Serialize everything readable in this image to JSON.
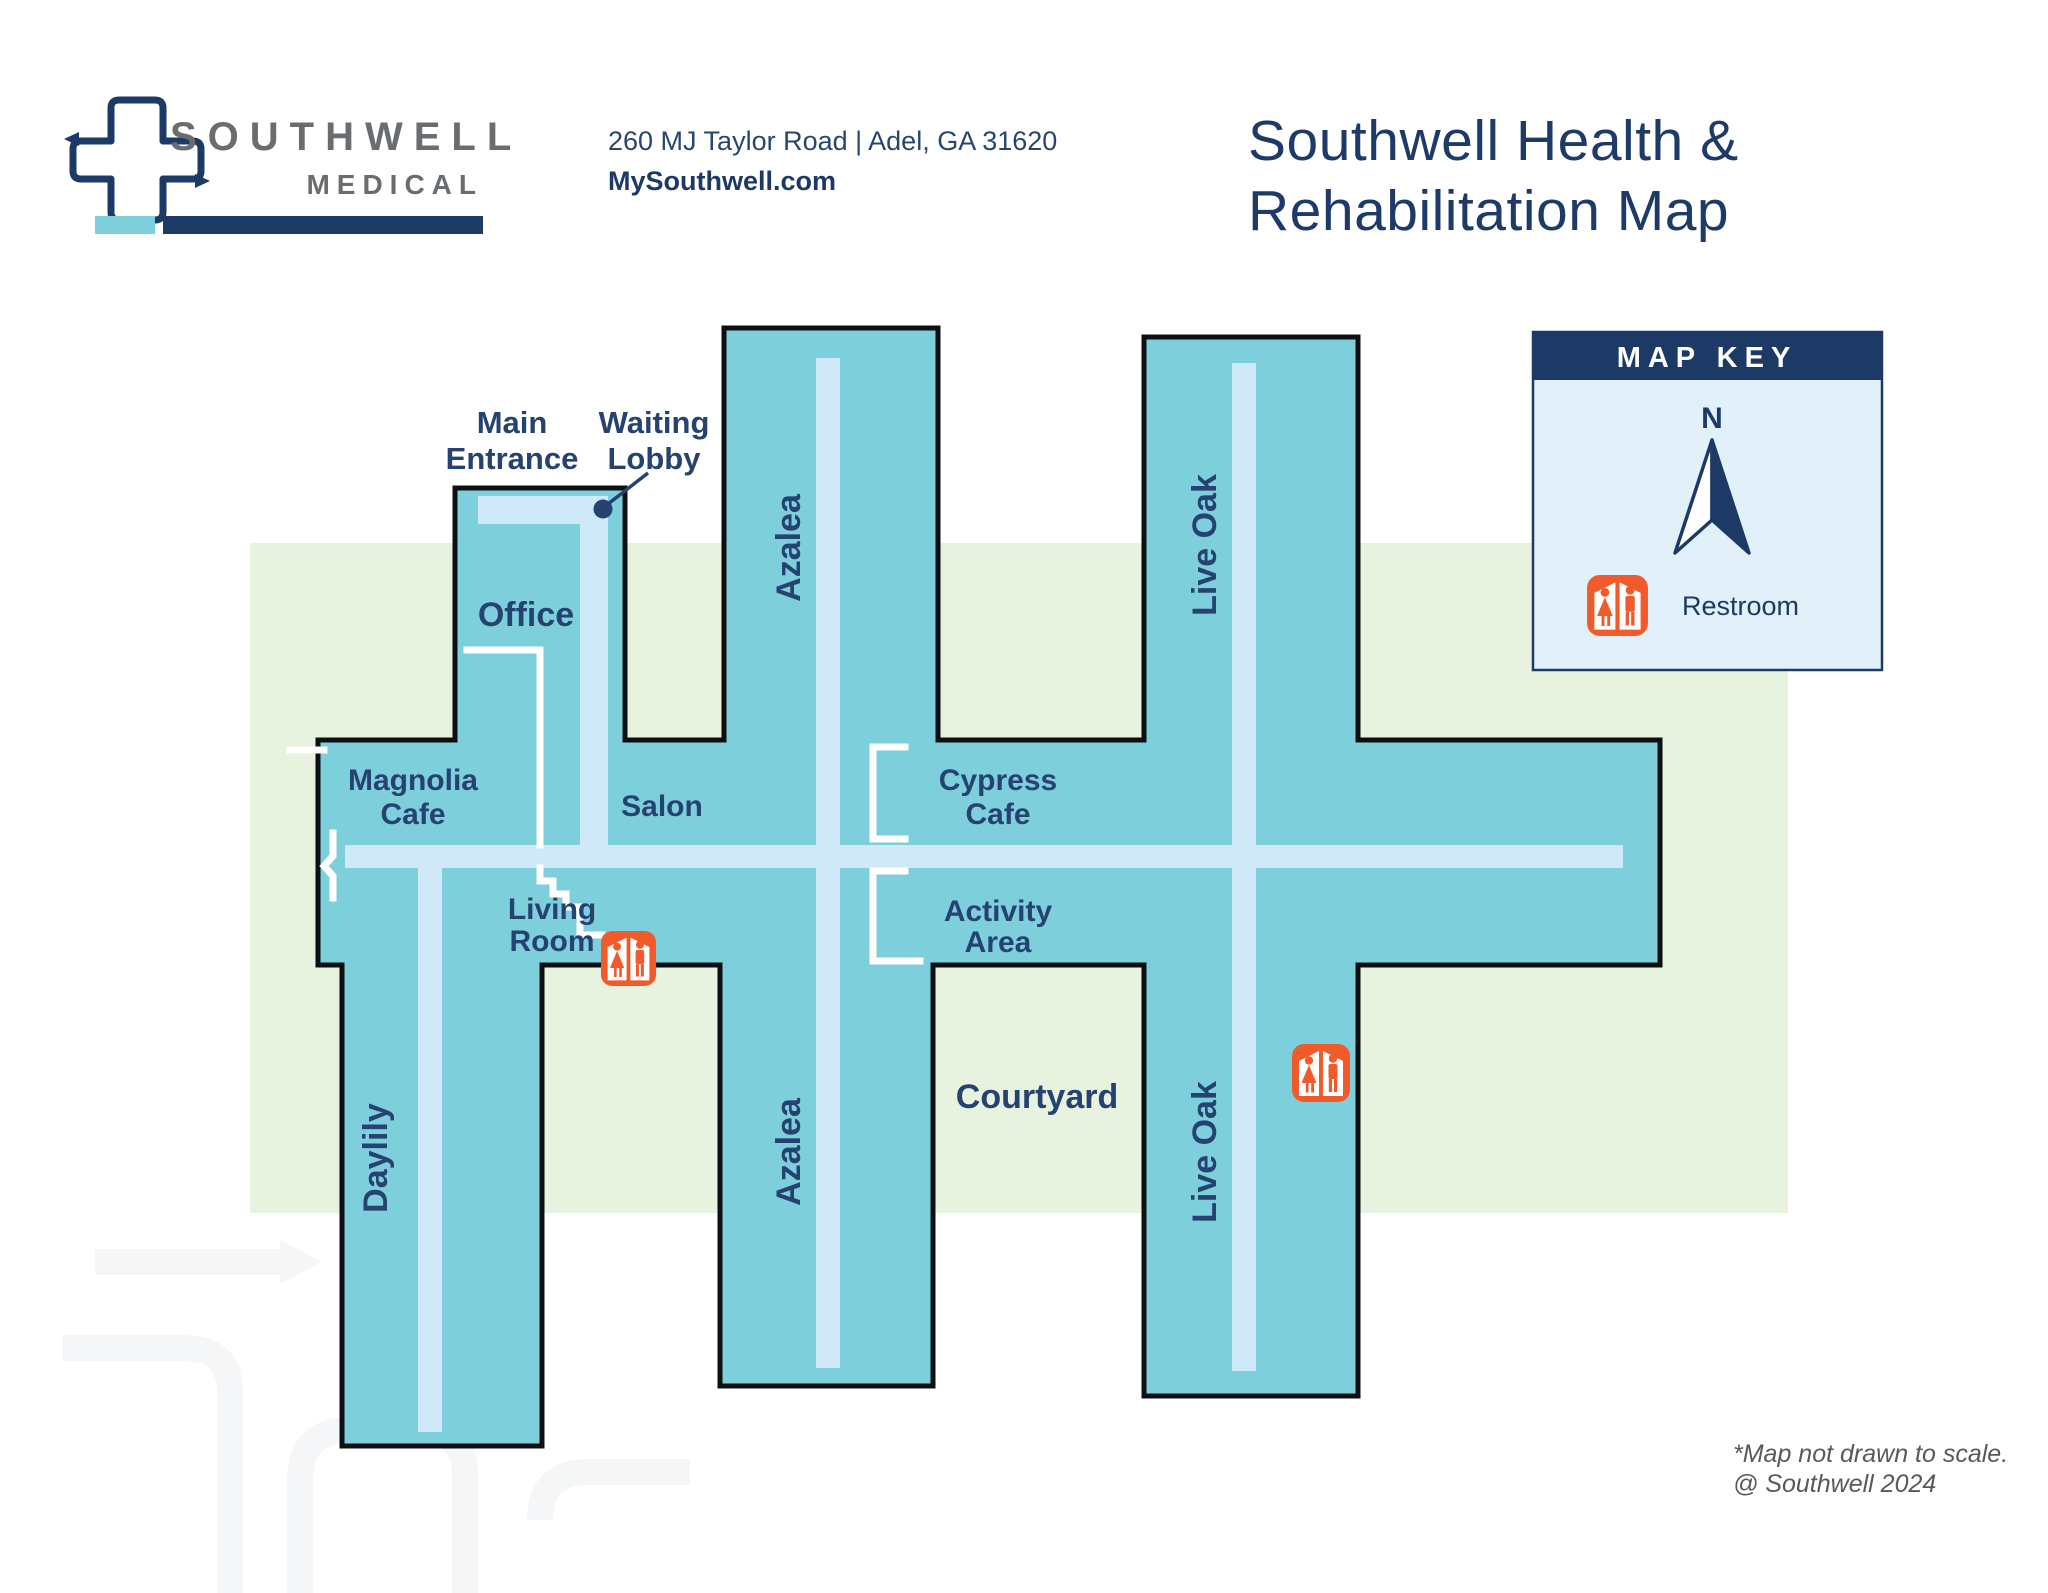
{
  "header": {
    "logo_name": "SOUTHWELL",
    "logo_sub": "MEDICAL",
    "address": "260 MJ Taylor Road | Adel, GA 31620",
    "website": "MySouthwell.com",
    "title_line1": "Southwell Health &",
    "title_line2": "Rehabilitation Map"
  },
  "map_key": {
    "title": "MAP KEY",
    "north_label": "N",
    "restroom_label": "Restroom"
  },
  "map": {
    "labels": {
      "main_entrance_line1": "Main",
      "main_entrance_line2": "Entrance",
      "waiting_lobby_line1": "Waiting",
      "waiting_lobby_line2": "Lobby",
      "office": "Office",
      "azalea_top": "Azalea",
      "live_oak_top": "Live Oak",
      "magnolia_cafe_line1": "Magnolia",
      "magnolia_cafe_line2": "Cafe",
      "salon": "Salon",
      "cypress_cafe_line1": "Cypress",
      "cypress_cafe_line2": "Cafe",
      "living_room_line1": "Living",
      "living_room_line2": "Room",
      "activity_area_line1": "Activity",
      "activity_area_line2": "Area",
      "courtyard": "Courtyard",
      "daylily": "Daylily",
      "azalea_bottom": "Azalea",
      "live_oak_bottom": "Live Oak"
    }
  },
  "footnote": {
    "line1": "*Map not drawn to scale.",
    "line2": "@ Southwell 2024"
  },
  "colors": {
    "navy": "#1d3a66",
    "label_navy": "#254270",
    "teal": "#7dcfdb",
    "hallway_blue": "#cfe9f8",
    "courtyard_green": "#e7f2df",
    "restroom_orange": "#f15b2c",
    "logo_gray": "#6a6d70",
    "key_panel_blue": "#e2f0f9",
    "footnote_gray": "#58595b"
  }
}
